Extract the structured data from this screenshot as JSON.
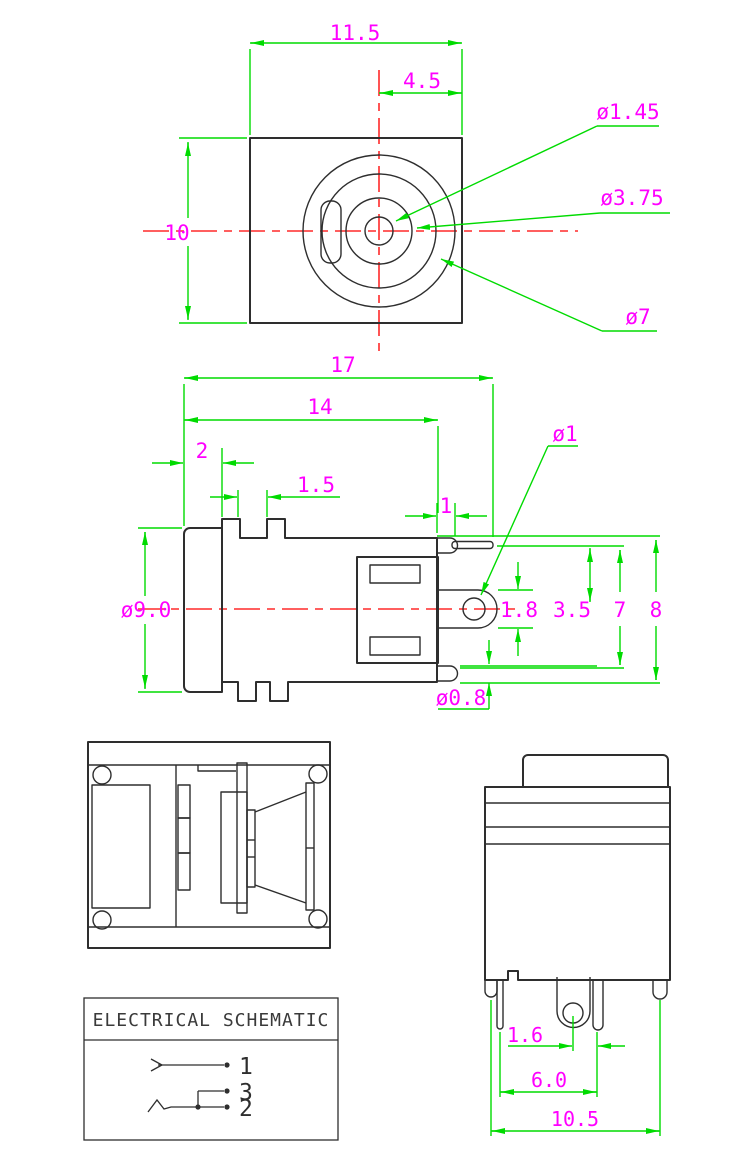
{
  "drawing": {
    "colors": {
      "dimension_green": "#00db00",
      "label_magenta": "#ff00ff",
      "centerline_red": "#ff2a2a",
      "outline_dark": "#2e2e2e"
    },
    "top_view": {
      "dim_width": "11.5",
      "dim_center_offset": "4.5",
      "dim_height": "10",
      "label_pin_dia": "ø1.45",
      "label_barrel_dia": "ø3.75",
      "label_ring_dia": "ø7"
    },
    "side_view": {
      "dim_total_length": "17",
      "dim_body_length": "14",
      "dim_cap": "2",
      "dim_slot": "1.5",
      "dim_pin_tab": "1",
      "label_hole_dia": "ø1",
      "dim_barrel_dia": "ø9.0",
      "dim_lug": "1.8",
      "dim_center_to_pin": "3.5",
      "dim_pin_pitch": "7",
      "dim_overall_height": "8",
      "label_terminal_dia": "ø0.8"
    },
    "rear_view": {
      "dim_pin_offset": "1.6",
      "dim_pin_span": "6.0",
      "dim_body_width": "10.5"
    },
    "schematic": {
      "title": "ELECTRICAL SCHEMATIC",
      "pin1_label": "1",
      "pin3_label": "3",
      "pin2_label": "2"
    }
  }
}
